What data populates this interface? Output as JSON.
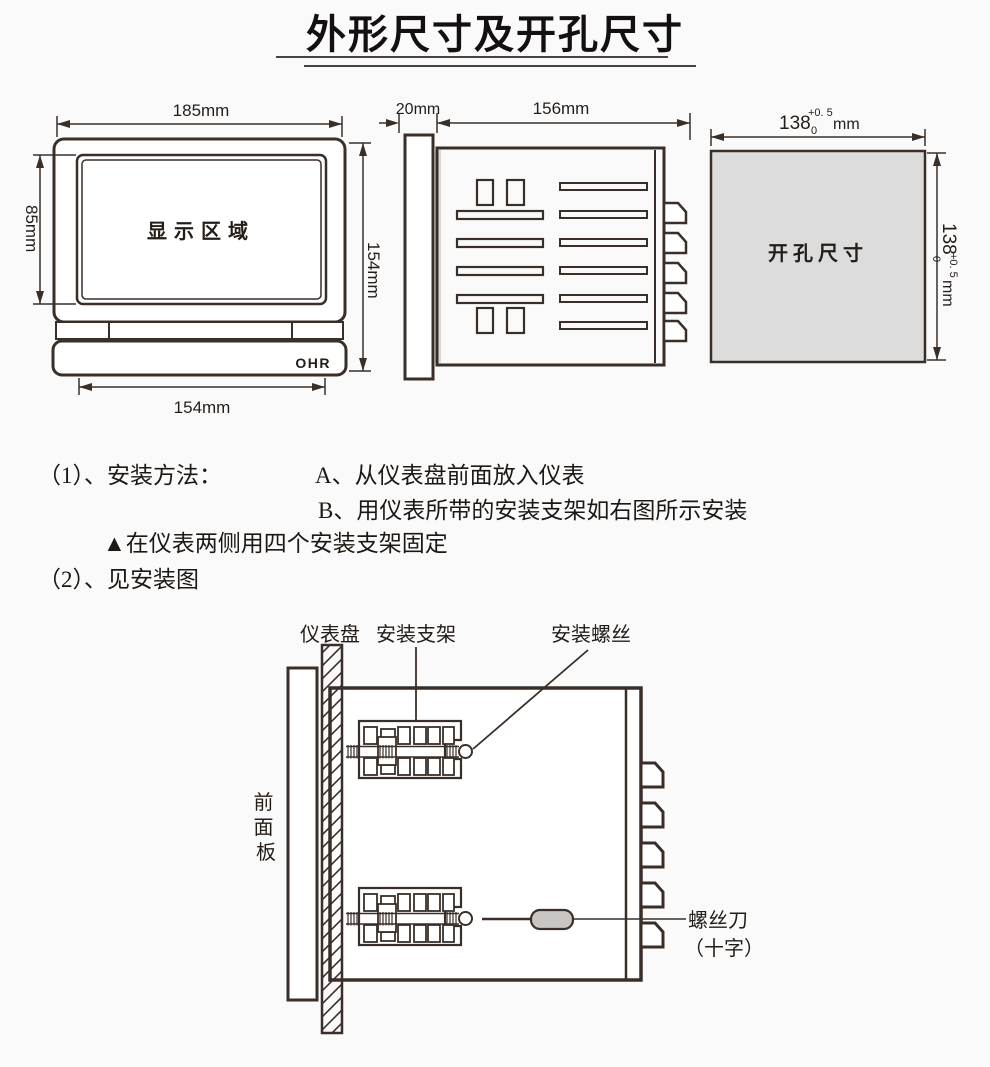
{
  "title": "外形尺寸及开孔尺寸",
  "front_view": {
    "width_dim": "185mm",
    "display_height_dim": "85mm",
    "height_dim": "154mm",
    "bottom_width_dim": "154mm",
    "display_label": "显示区域",
    "brand": "OHR"
  },
  "side_view": {
    "bezel_depth_dim": "20mm",
    "body_depth_dim": "156mm"
  },
  "cutout_view": {
    "label": "开孔尺寸",
    "width_value": "138",
    "width_tol_upper": "+0. 5",
    "width_tol_lower": "0",
    "width_unit": "mm",
    "height_value": "138",
    "height_tol_upper": "+0. 5",
    "height_tol_lower": "0",
    "height_unit": "mm"
  },
  "instructions": {
    "item1_label": "（1）、安装方法：",
    "step_a": "A、从仪表盘前面放入仪表",
    "step_b": "B、用仪表所带的安装支架如右图所示安装",
    "note": "▲在仪表两侧用四个安装支架固定",
    "item2_label": "（2）、见安装图"
  },
  "install_diagram": {
    "panel_label": "仪表盘",
    "bracket_label": "安装支架",
    "screw_label": "安装螺丝",
    "front_panel_chars": [
      "前",
      "面",
      "板"
    ],
    "screwdriver_label": "螺丝刀",
    "screwdriver_type": "（十字）"
  },
  "colors": {
    "line": "#3a2f28",
    "cutout_fill": "#dcdcdc",
    "handle_fill": "#c8c5c3"
  }
}
